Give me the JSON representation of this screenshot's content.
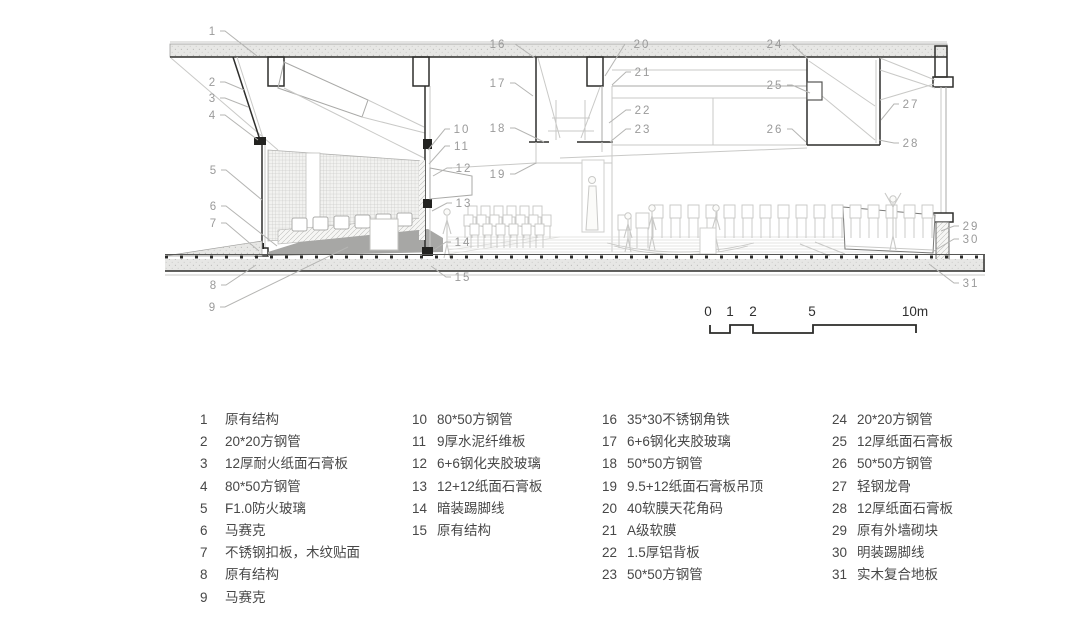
{
  "drawing": {
    "title": "building-section-axonometric",
    "callouts": [
      {
        "n": "1",
        "x": 213,
        "y": 31,
        "tx": 257,
        "ty": 56
      },
      {
        "n": "2",
        "x": 213,
        "y": 82,
        "tx": 244,
        "ty": 90
      },
      {
        "n": "3",
        "x": 213,
        "y": 98,
        "tx": 248,
        "ty": 107
      },
      {
        "n": "4",
        "x": 213,
        "y": 115,
        "tx": 258,
        "ty": 140
      },
      {
        "n": "5",
        "x": 214,
        "y": 170,
        "tx": 262,
        "ty": 200
      },
      {
        "n": "6",
        "x": 214,
        "y": 206,
        "tx": 277,
        "ty": 246
      },
      {
        "n": "7",
        "x": 214,
        "y": 223,
        "tx": 259,
        "ty": 251
      },
      {
        "n": "8",
        "x": 214,
        "y": 285,
        "tx": 256,
        "ty": 265
      },
      {
        "n": "9",
        "x": 213,
        "y": 307,
        "tx": 348,
        "ty": 247
      },
      {
        "n": "10",
        "x": 462,
        "y": 129,
        "tx": 428,
        "ty": 150
      },
      {
        "n": "11",
        "x": 462,
        "y": 146,
        "tx": 429,
        "ty": 164
      },
      {
        "n": "12",
        "x": 464,
        "y": 168,
        "tx": 433,
        "ty": 176
      },
      {
        "n": "13",
        "x": 464,
        "y": 203,
        "tx": 432,
        "ty": 211
      },
      {
        "n": "14",
        "x": 463,
        "y": 242,
        "tx": 434,
        "ty": 250
      },
      {
        "n": "15",
        "x": 463,
        "y": 277,
        "tx": 431,
        "ty": 266
      },
      {
        "n": "16",
        "x": 498,
        "y": 44,
        "tx": 535,
        "ty": 58
      },
      {
        "n": "17",
        "x": 498,
        "y": 83,
        "tx": 533,
        "ty": 96
      },
      {
        "n": "18",
        "x": 498,
        "y": 128,
        "tx": 544,
        "ty": 142
      },
      {
        "n": "19",
        "x": 498,
        "y": 174,
        "tx": 536,
        "ty": 163
      },
      {
        "n": "20",
        "x": 642,
        "y": 44,
        "tx": 605,
        "ty": 76
      },
      {
        "n": "21",
        "x": 643,
        "y": 72,
        "tx": 612,
        "ty": 85
      },
      {
        "n": "22",
        "x": 643,
        "y": 110,
        "tx": 609,
        "ty": 123
      },
      {
        "n": "23",
        "x": 643,
        "y": 129,
        "tx": 610,
        "ty": 142
      },
      {
        "n": "24",
        "x": 775,
        "y": 44,
        "tx": 808,
        "ty": 59
      },
      {
        "n": "25",
        "x": 775,
        "y": 85,
        "tx": 810,
        "ty": 93
      },
      {
        "n": "26",
        "x": 775,
        "y": 129,
        "tx": 806,
        "ty": 142
      },
      {
        "n": "27",
        "x": 911,
        "y": 104,
        "tx": 881,
        "ty": 120
      },
      {
        "n": "28",
        "x": 911,
        "y": 143,
        "tx": 879,
        "ty": 140
      },
      {
        "n": "29",
        "x": 971,
        "y": 226,
        "tx": 941,
        "ty": 231
      },
      {
        "n": "30",
        "x": 971,
        "y": 239,
        "tx": 934,
        "ty": 251
      },
      {
        "n": "31",
        "x": 971,
        "y": 283,
        "tx": 929,
        "ty": 264
      }
    ]
  },
  "scale_bar": {
    "labels": [
      {
        "t": "0",
        "x": 708
      },
      {
        "t": "1",
        "x": 730
      },
      {
        "t": "2",
        "x": 753
      },
      {
        "t": "5",
        "x": 812
      },
      {
        "t": "10m",
        "x": 915
      }
    ]
  },
  "legend": {
    "columns": [
      {
        "items": [
          {
            "n": "1",
            "label": "原有结构"
          },
          {
            "n": "2",
            "label": "20*20方钢管"
          },
          {
            "n": "3",
            "label": "12厚耐火纸面石膏板"
          },
          {
            "n": "4",
            "label": "80*50方钢管"
          },
          {
            "n": "5",
            "label": "F1.0防火玻璃"
          },
          {
            "n": "6",
            "label": "马赛克"
          },
          {
            "n": "7",
            "label": "不锈钢扣板，木纹贴面"
          },
          {
            "n": "8",
            "label": "原有结构"
          },
          {
            "n": "9",
            "label": "马赛克"
          }
        ]
      },
      {
        "items": [
          {
            "n": "10",
            "label": "80*50方钢管"
          },
          {
            "n": "11",
            "label": "9厚水泥纤维板"
          },
          {
            "n": "12",
            "label": "6+6钢化夹胶玻璃"
          },
          {
            "n": "13",
            "label": "12+12纸面石膏板"
          },
          {
            "n": "14",
            "label": "暗装踢脚线"
          },
          {
            "n": "15",
            "label": "原有结构"
          }
        ]
      },
      {
        "items": [
          {
            "n": "16",
            "label": "35*30不锈钢角铁"
          },
          {
            "n": "17",
            "label": "6+6钢化夹胶玻璃"
          },
          {
            "n": "18",
            "label": "50*50方钢管"
          },
          {
            "n": "19",
            "label": "9.5+12纸面石膏板吊顶"
          },
          {
            "n": "20",
            "label": "40软膜天花角码"
          },
          {
            "n": "21",
            "label": "A级软膜"
          },
          {
            "n": "22",
            "label": "1.5厚铝背板"
          },
          {
            "n": "23",
            "label": "50*50方钢管"
          }
        ]
      },
      {
        "items": [
          {
            "n": "24",
            "label": "20*20方钢管"
          },
          {
            "n": "25",
            "label": "12厚纸面石膏板"
          },
          {
            "n": "26",
            "label": "50*50方钢管"
          },
          {
            "n": "27",
            "label": "轻钢龙骨"
          },
          {
            "n": "28",
            "label": "12厚纸面石膏板"
          },
          {
            "n": "29",
            "label": "原有外墙砌块"
          },
          {
            "n": "30",
            "label": "明装踢脚线"
          },
          {
            "n": "31",
            "label": "实木复合地板"
          }
        ]
      }
    ]
  },
  "colors": {
    "callout_text": "#9a9a9a",
    "leader_line": "#b5b5b3",
    "legend_text": "#474747",
    "scale_text": "#2f2f2f",
    "cut_line": "#2e2e2c",
    "slab_fill": "#e7e7e5",
    "mosaic_floor": "#a7a7a5"
  }
}
